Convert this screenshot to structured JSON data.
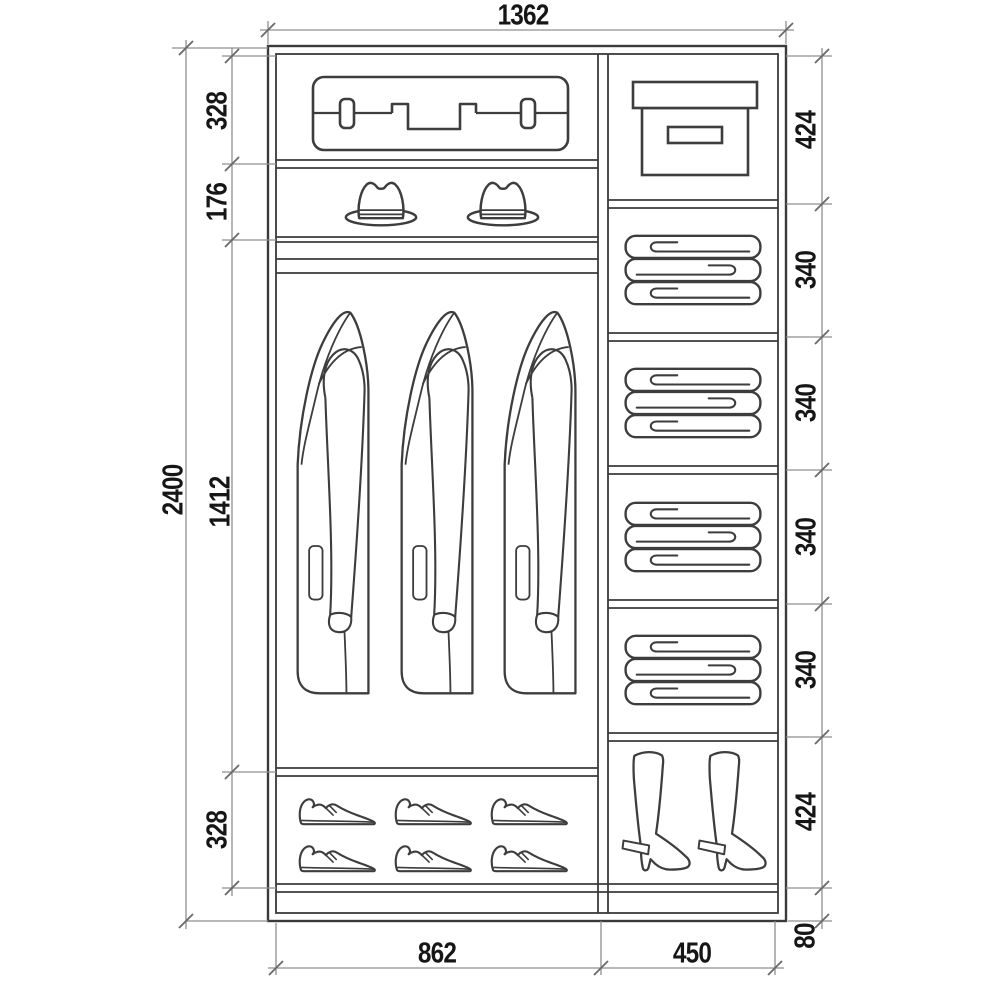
{
  "title": "Wardrobe interior dimensional drawing",
  "dimensions": {
    "total_width": "1362",
    "total_height": "2400",
    "left_sections": {
      "suitcase_shelf": "328",
      "hat_shelf": "176",
      "hanging_area": "1412",
      "shoe_shelf": "328"
    },
    "right_sections": {
      "box_shelf": "424",
      "linen_shelf_1": "340",
      "linen_shelf_2": "340",
      "linen_shelf_3": "340",
      "linen_shelf_4": "340",
      "boot_shelf": "424",
      "base": "80"
    },
    "column_widths": {
      "left_column": "862",
      "right_column": "450"
    }
  },
  "icons": {
    "suitcase": "suitcase-icon",
    "fedora_hat": "fedora-hat-icon",
    "coat": "coat-on-hanger-icon",
    "dress_shoe": "dress-shoe-icon",
    "storage_box": "storage-box-icon",
    "folded_linens": "folded-linens-icon",
    "heeled_boot": "heeled-boot-icon"
  },
  "colors": {
    "line": "#3d3d3d",
    "dimension_line": "#8f8f8f",
    "text": "#161616",
    "background": "#ffffff"
  }
}
